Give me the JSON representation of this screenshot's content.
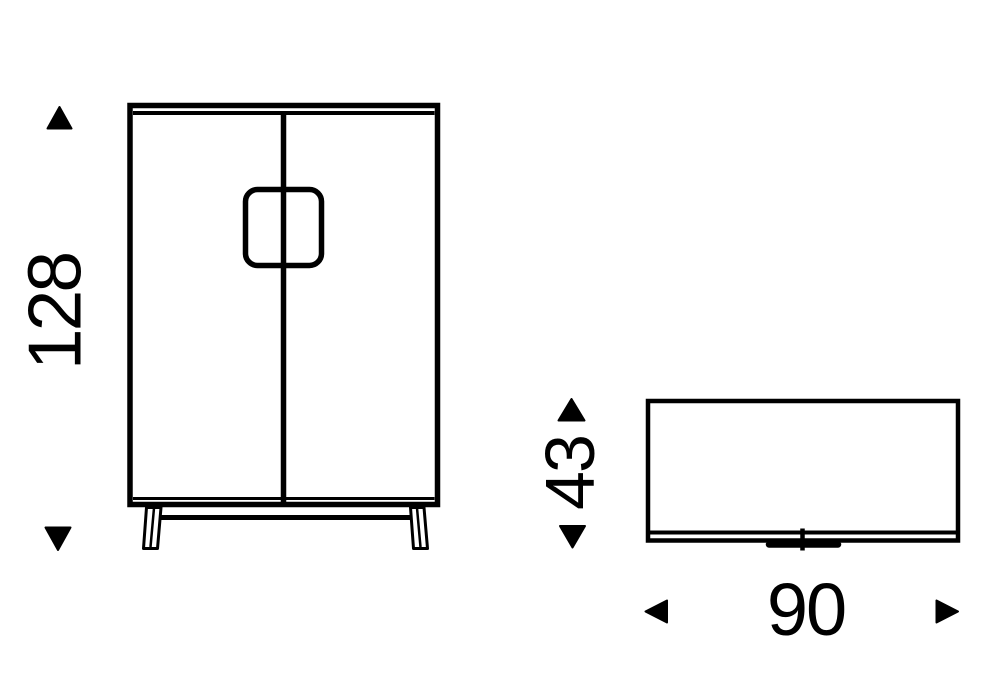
{
  "colors": {
    "line": "#000000",
    "background": "#ffffff"
  },
  "diagram": {
    "dimensions": {
      "height": {
        "value": "128"
      },
      "depth": {
        "value": "43"
      },
      "width": {
        "value": "90"
      }
    }
  }
}
